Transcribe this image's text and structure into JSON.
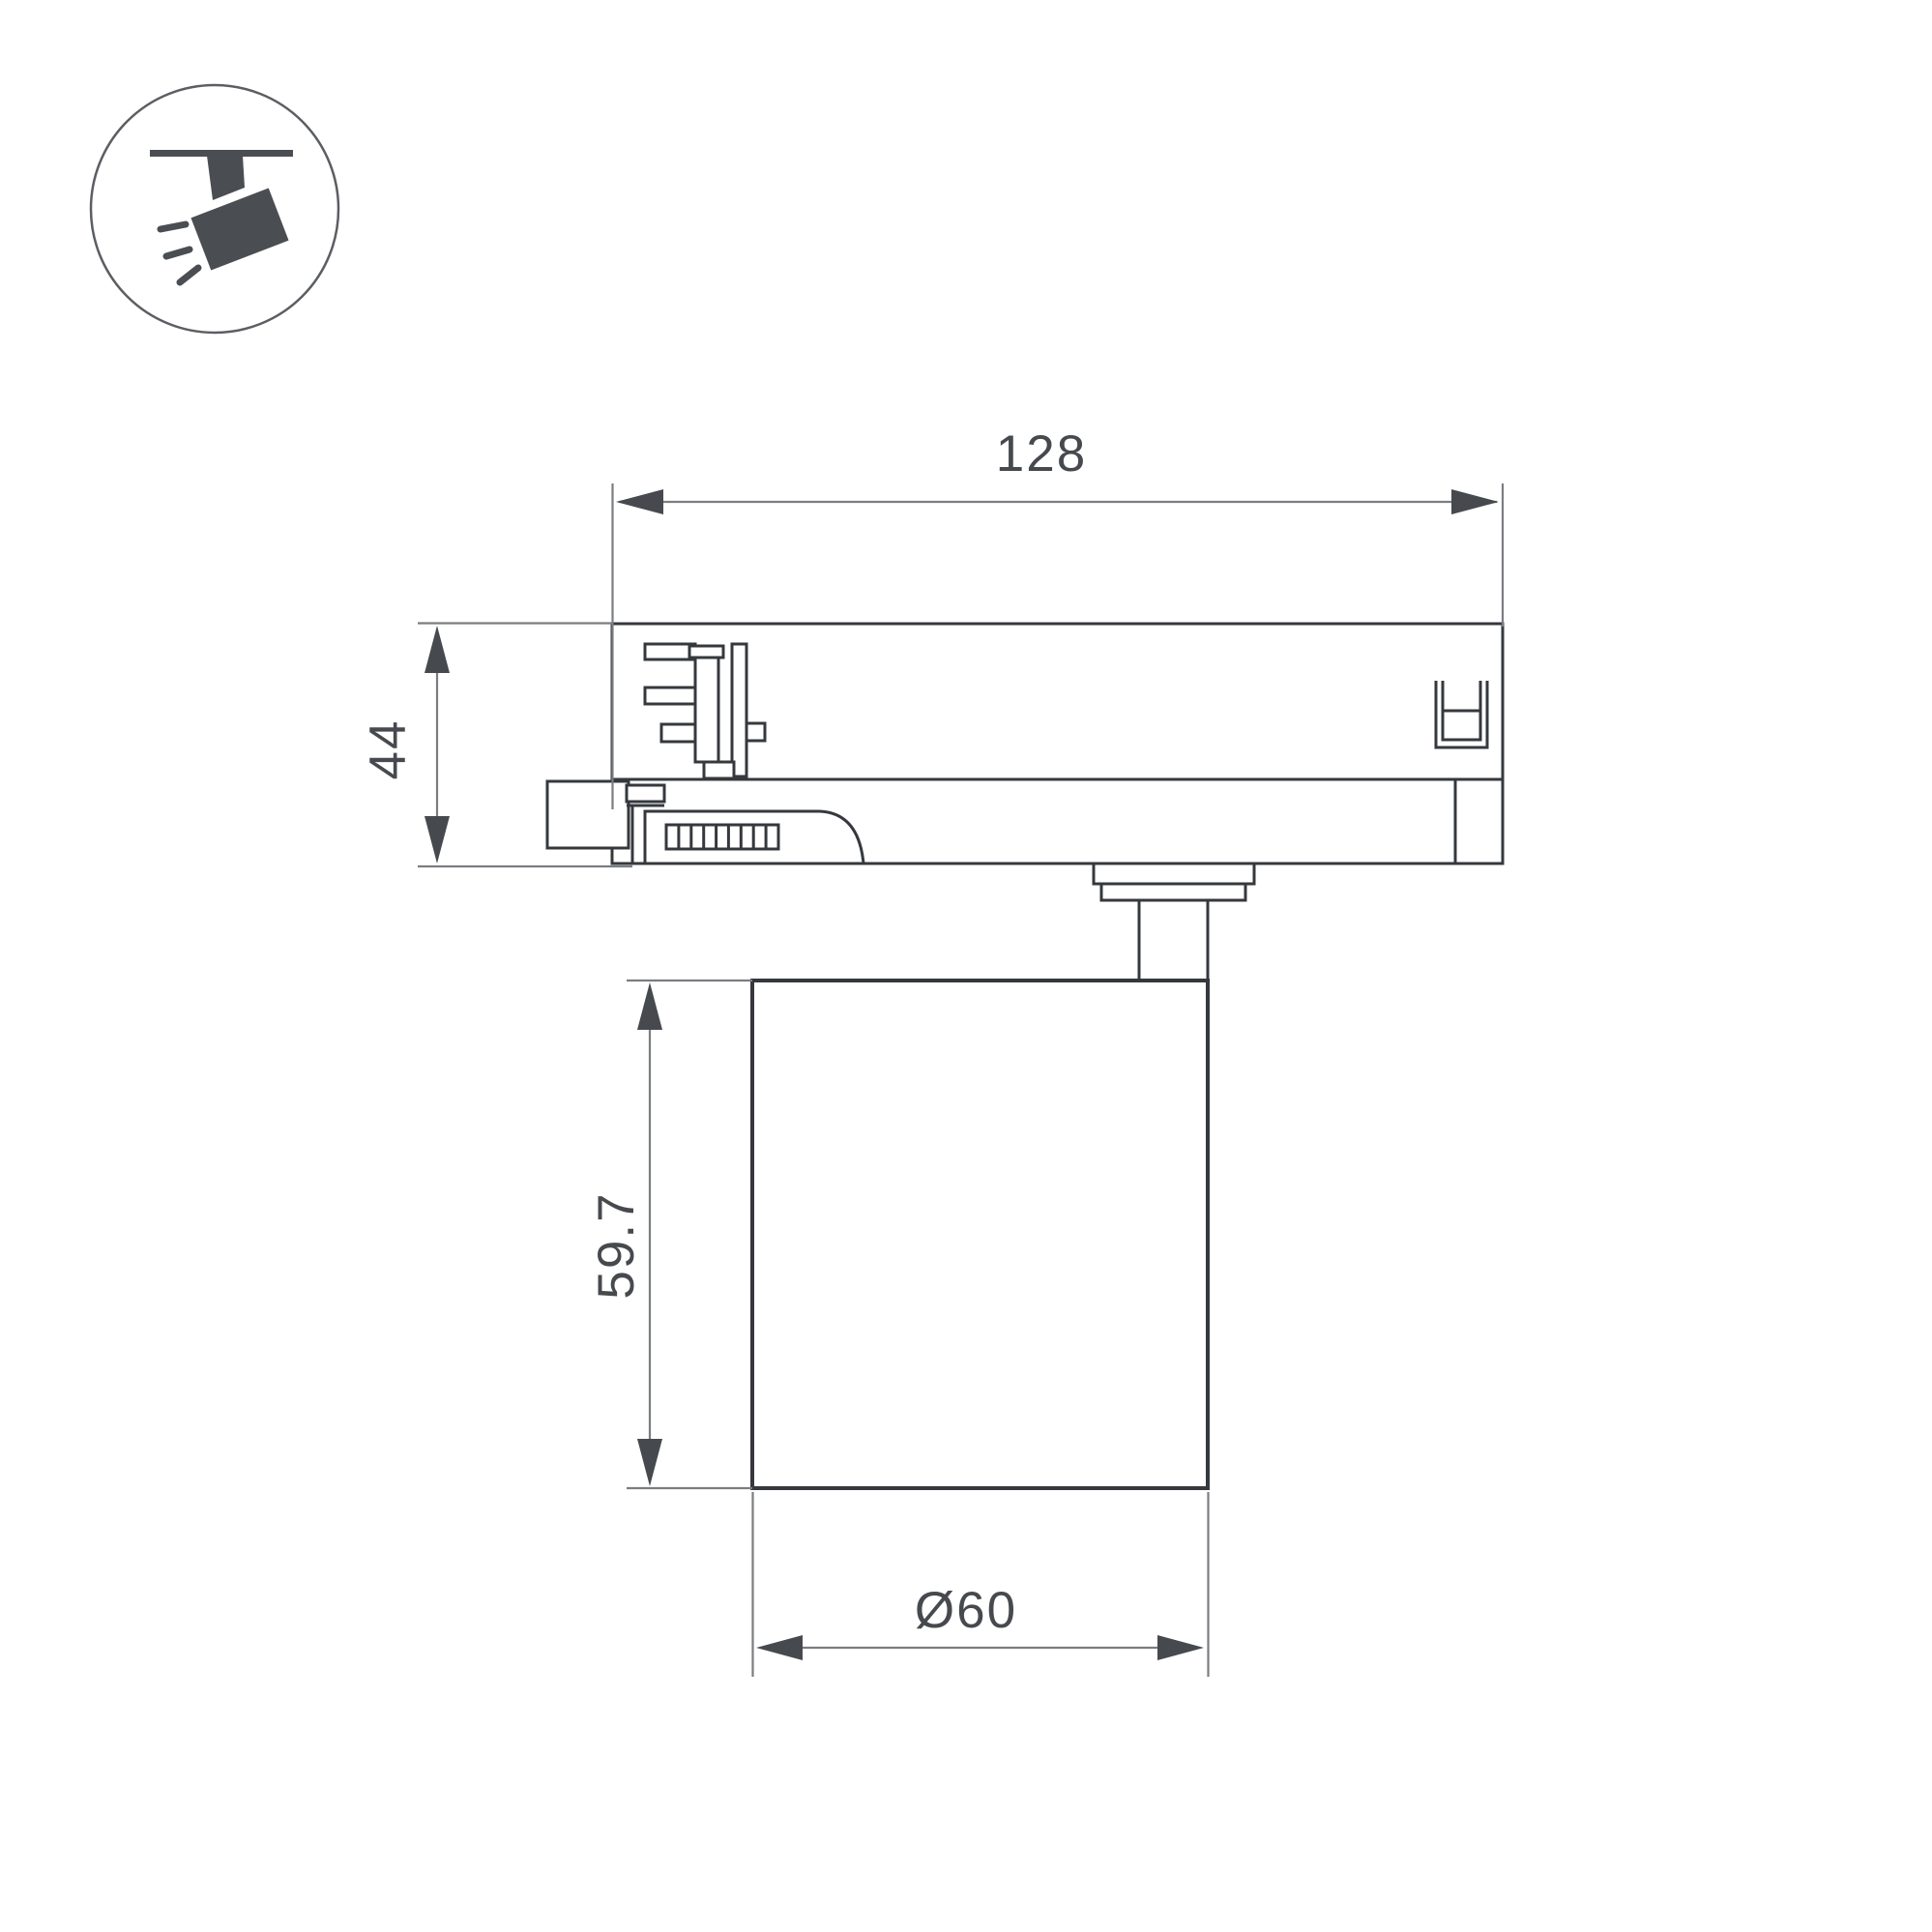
{
  "icon": {
    "name": "track-spotlight"
  },
  "dims": {
    "track_width": {
      "label": "128"
    },
    "adapter_height": {
      "label": "44"
    },
    "body_height": {
      "label": "59.7"
    },
    "body_diameter": {
      "label": "Ø60"
    }
  },
  "colors": {
    "bg": "#ffffff",
    "line-dark": "#35383d",
    "line-thin": "#7a7d81",
    "ink": "#46494e",
    "icon-fill": "#4a4d52",
    "circle-stroke": "#5b5e62"
  }
}
